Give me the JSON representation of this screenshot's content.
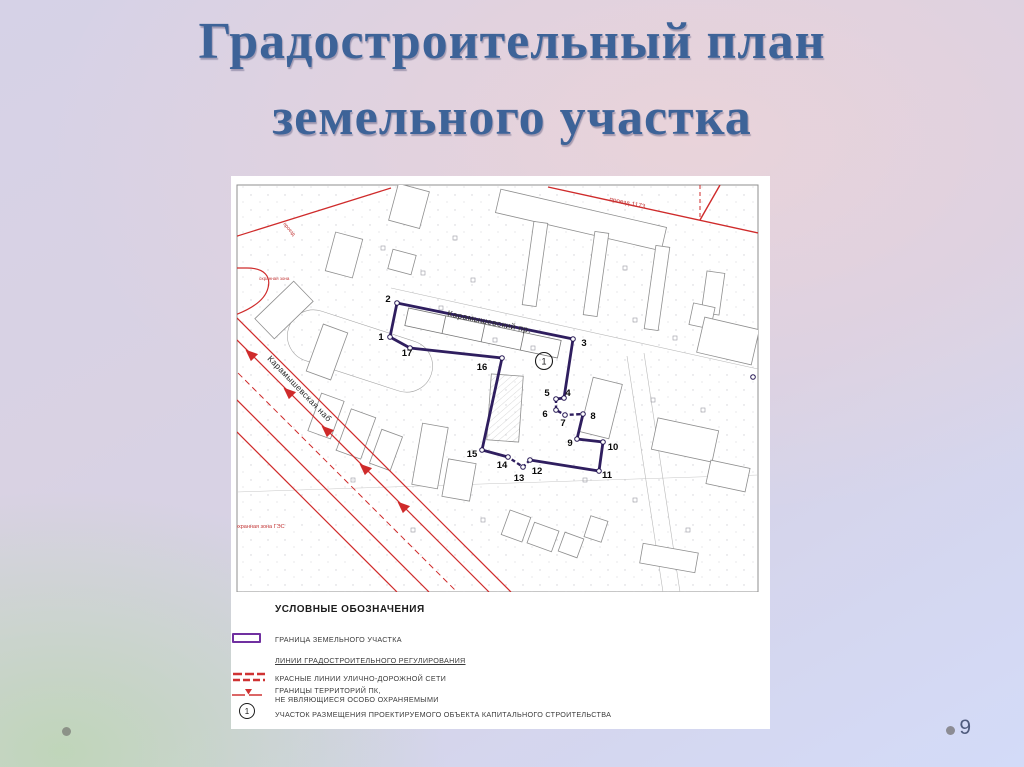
{
  "slide": {
    "title_line1": "Градостроительный план",
    "title_line2": "земельного участка",
    "page_number": "9"
  },
  "map": {
    "street_label_1": "Карамышевский пр.",
    "street_label_2": "Карамышевская наб",
    "red_label_top_right": "проезд 1173",
    "red_label_top_left": "проезд",
    "red_label_curve": "охранная зона",
    "red_label_left": "охранная зона ГЭС",
    "site_marker": "1",
    "edge_point_label": "1",
    "point_labels": [
      "1",
      "2",
      "3",
      "4",
      "5",
      "6",
      "7",
      "8",
      "9",
      "10",
      "11",
      "12",
      "13",
      "14",
      "15",
      "16",
      "17"
    ]
  },
  "legend": {
    "title": "УСЛОВНЫЕ ОБОЗНАЧЕНИЯ",
    "items": [
      {
        "label": "ГРАНИЦА ЗЕМЕЛЬНОГО УЧАСТКА"
      },
      {
        "label": "ЛИНИИ ГРАДОСТРОИТЕЛЬНОГО РЕГУЛИРОВАНИЯ"
      },
      {
        "label": "КРАСНЫЕ ЛИНИИ УЛИЧНО-ДОРОЖНОЙ СЕТИ"
      },
      {
        "label": "ГРАНИЦЫ ТЕРРИТОРИЙ ПК,",
        "label2": "НЕ ЯВЛЯЮЩИЕСЯ ОСОБО ОХРАНЯЕМЫМИ"
      },
      {
        "label": "УЧАСТОК РАЗМЕЩЕНИЯ ПРОЕКТИРУЕМОГО ОБЪЕКТА КАПИТАЛЬНОГО СТРОИТЕЛЬСТВА",
        "marker": "1"
      }
    ]
  },
  "colors": {
    "title": "#3d6398",
    "red_line": "#cf2b2b",
    "boundary": "#2f1e5f",
    "legend_purple": "#7030a0",
    "background_blue": "#d3dbf8",
    "background_green": "#cfdccb",
    "background_pink": "#e7d5db"
  }
}
